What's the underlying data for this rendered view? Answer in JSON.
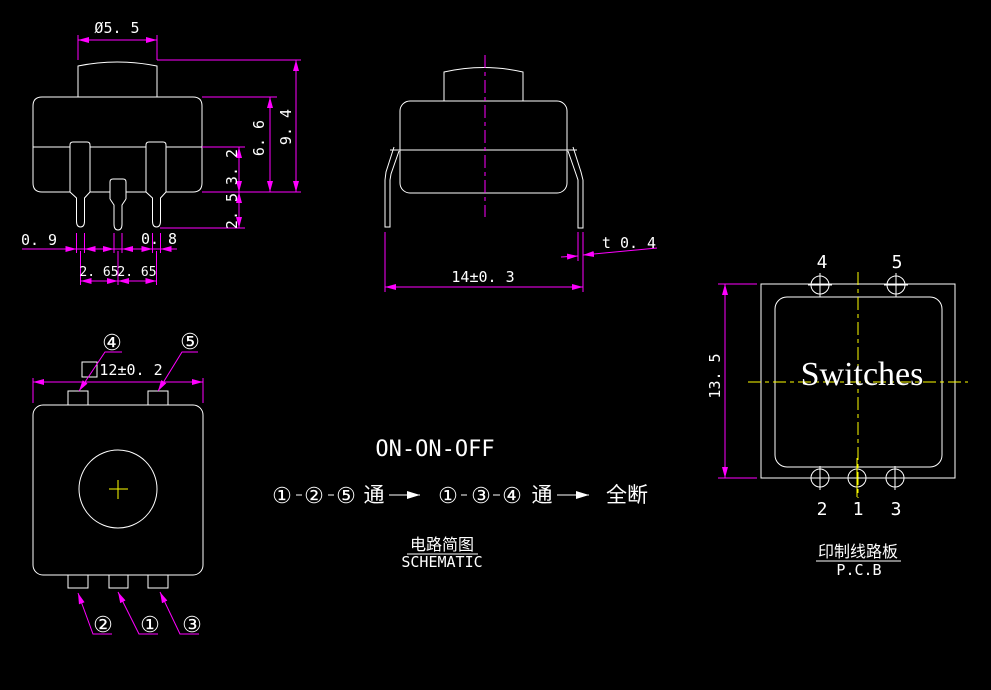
{
  "colors": {
    "background": "#000000",
    "geometry_line": "#ffffff",
    "dimension_line": "#ff00ff",
    "centerline": "#ffff00",
    "text": "#ffffff"
  },
  "side": {
    "knob_dia": "Ø5. 5",
    "total_height": "9. 4",
    "body_height": "6. 6",
    "pin_shoulder": "3. 2",
    "pin_tip_len": "2. 5",
    "pin_width_left": "0. 9",
    "pin_width_right": "0. 8",
    "pitch_left": "2. 65",
    "pitch_right": "2. 65"
  },
  "front": {
    "width": "14±0. 3",
    "terminal_thickness": "t 0. 4"
  },
  "bottom": {
    "size": "12±0. 2",
    "label_4": "④",
    "label_5": "⑤",
    "label_2": "②",
    "label_1": "①",
    "label_3": "③"
  },
  "schematic": {
    "title": "ON-ON-OFF",
    "s1_a": "①",
    "s1_b": "②",
    "s1_c": "⑤",
    "s1_on": "通",
    "s2_a": "①",
    "s2_b": "③",
    "s2_c": "④",
    "s2_on": "通",
    "all_off": "全断",
    "caption_cn": "电路简图",
    "caption_en": "SCHEMATIC"
  },
  "pcb": {
    "title": "Switches",
    "height": "13. 5",
    "hole_4": "4",
    "hole_5": "5",
    "hole_2": "2",
    "hole_1": "1",
    "hole_3": "3",
    "caption_cn": "印制线路板",
    "caption_en": "P.C.B"
  }
}
